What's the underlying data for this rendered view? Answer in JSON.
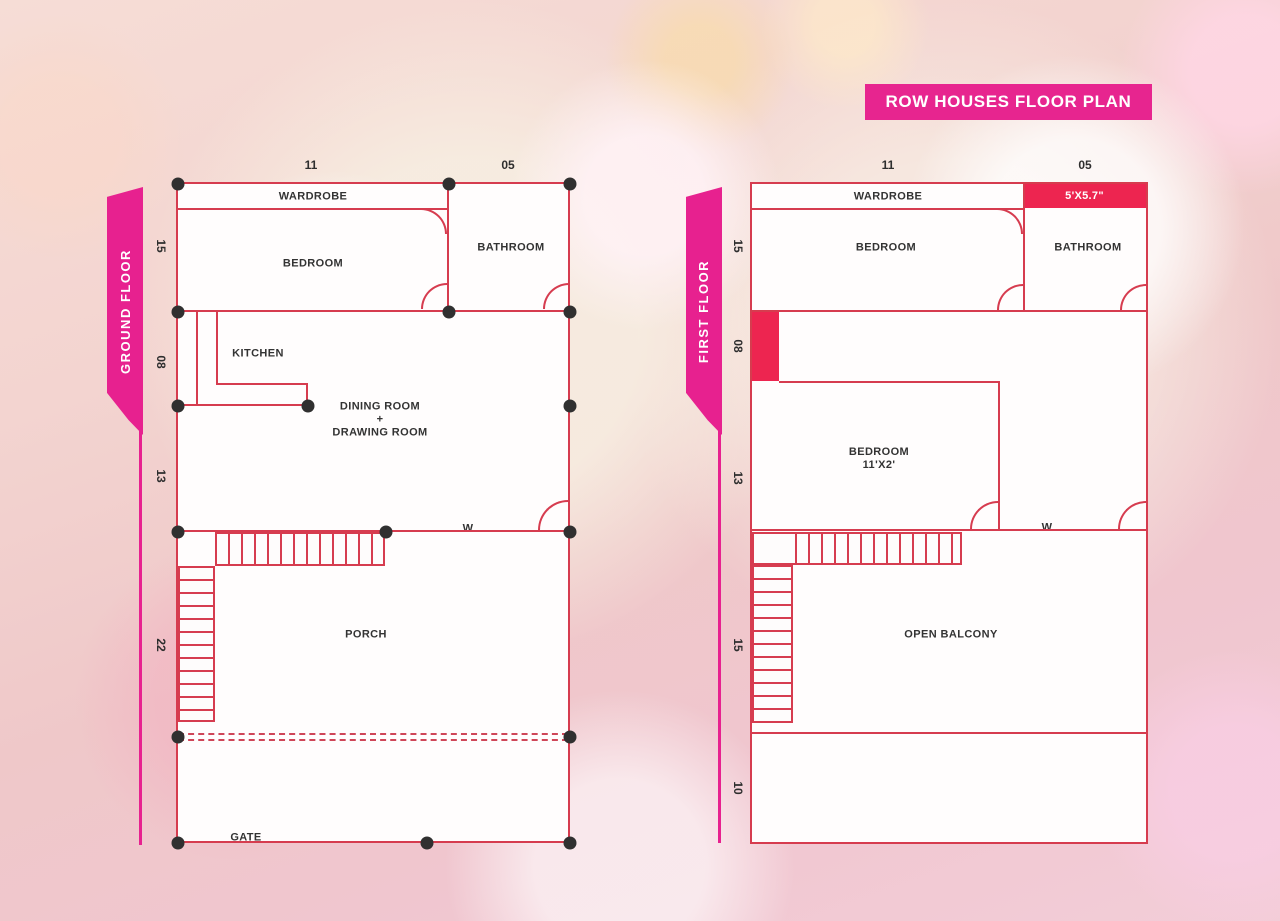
{
  "title": "ROW HOUSES FLOOR PLAN",
  "colors": {
    "wall": "#d63c4f",
    "filled_block": "#ed2550",
    "ribbon": "#e7218f",
    "banner": "#e7258f",
    "junction_dot": "#303030",
    "label_text": "#333333"
  },
  "ground_floor": {
    "ribbon": "GROUND FLOOR",
    "dim_top": [
      "11",
      "05"
    ],
    "dim_side": [
      "15",
      "08",
      "13",
      "22"
    ],
    "labels": {
      "wardrobe": "WARDROBE",
      "bedroom": "BEDROOM",
      "bathroom": "BATHROOM",
      "kitchen": "KITCHEN",
      "dining1": "DINING ROOM",
      "dining2": "+",
      "dining3": "DRAWING ROOM",
      "window": "W",
      "porch": "PORCH",
      "gate": "GATE"
    }
  },
  "first_floor": {
    "ribbon": "FIRST FLOOR",
    "dim_top": [
      "11",
      "05"
    ],
    "dim_side": [
      "15",
      "08",
      "13",
      "15",
      "10"
    ],
    "labels": {
      "wardrobe": "WARDROBE",
      "bath_size": "5'X5.7\"",
      "bedroom": "BEDROOM",
      "bathroom": "BATHROOM",
      "bedroom2_name": "BEDROOM",
      "bedroom2_size": "11'X2'",
      "window": "W",
      "balcony": "OPEN BALCONY"
    }
  }
}
